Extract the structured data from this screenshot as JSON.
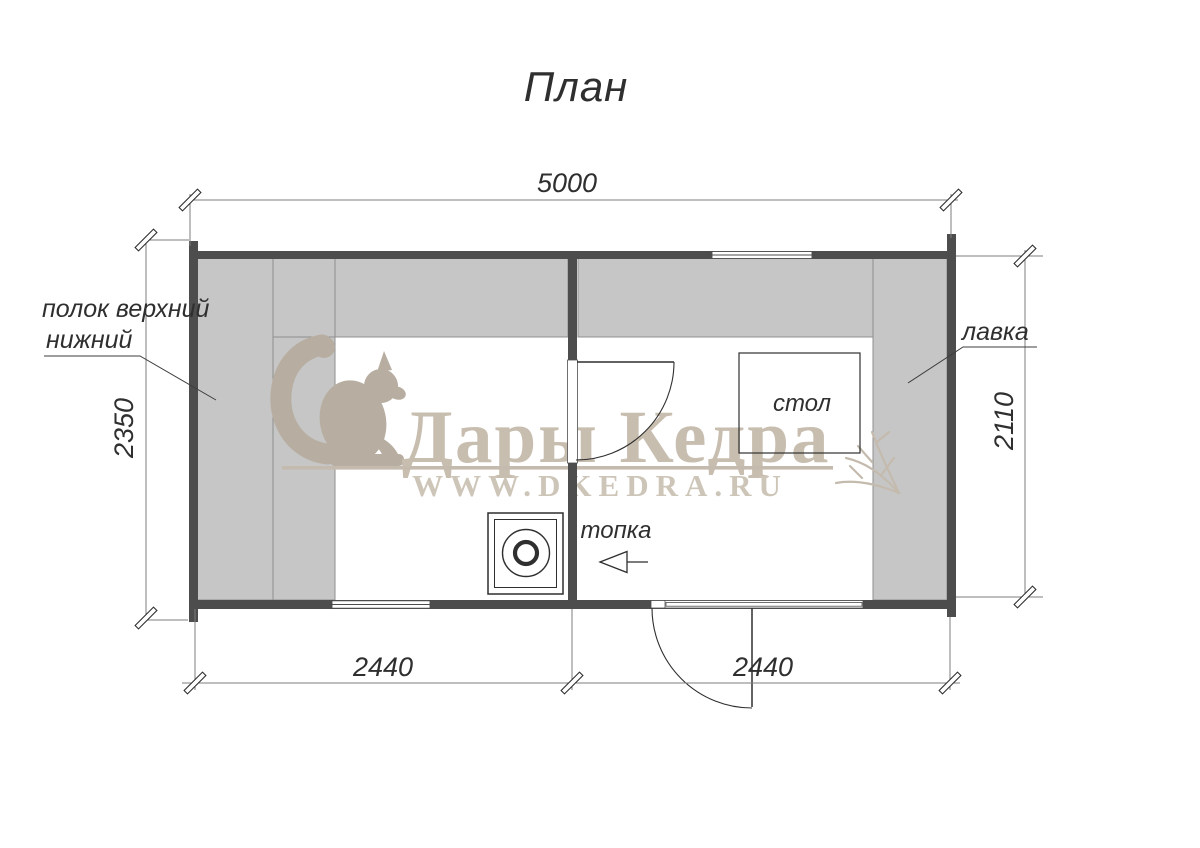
{
  "title": "План",
  "plan": {
    "dimensions": {
      "total_width": "5000",
      "left_height": "2350",
      "right_height": "2110",
      "bottom_left_width": "2440",
      "bottom_right_width": "2440"
    },
    "labels": {
      "shelf_line1": "полок  верхний",
      "shelf_line2": "нижний",
      "bench": "лавка",
      "table": "стол",
      "firebox": "топка"
    }
  },
  "watermark": {
    "brand": "Дары Кедра",
    "website": "WWW.DKEDRA.RU"
  },
  "colors": {
    "wall": "#4d4d4d",
    "furniture_fill": "#c6c6c6",
    "furniture_edge": "#8f8f8f",
    "dimension_line": "#7d7d7d",
    "drawing_line": "#2f2f2f",
    "watermark_tan": "#c8beb0"
  }
}
